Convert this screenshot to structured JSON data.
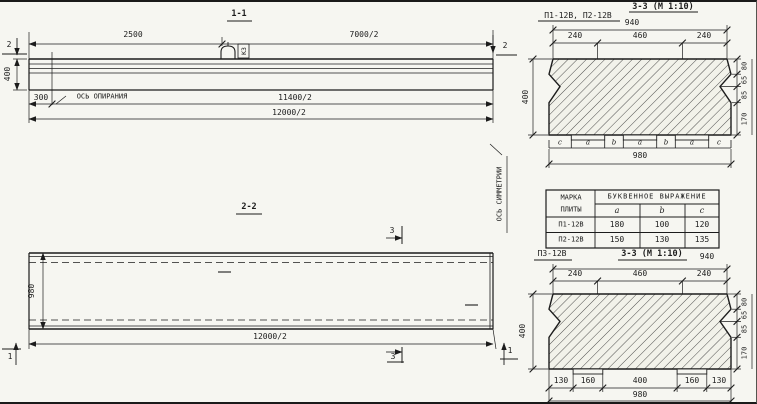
{
  "colors": {
    "paper": "#f6f6f1",
    "ink": "#1c1c1c"
  },
  "section_1_1": {
    "title": "1-1",
    "cut_marker_left": "2",
    "cut_marker_right": "2",
    "dim_top_left": "2500",
    "dim_top_right": "7000/2",
    "dim_height": "400",
    "dim_support_offset": "300",
    "dim_bottom_inner": "11400/2",
    "dim_bottom_outer": "12000/2",
    "support_axis_label": "ОСЬ ОПИРАНИЯ",
    "lifting_loop_label": "К3"
  },
  "section_2_2": {
    "title": "2-2",
    "dim_width": "980",
    "dim_length": "12000/2",
    "cut_marker_3_top": "3",
    "cut_marker_3_bottom": "3",
    "cut_marker_1_left": "1",
    "cut_marker_1_right": "1",
    "symmetry_axis_label": "ОСЬ СИММЕТРИИ"
  },
  "section_3_3_upper": {
    "plate_marks_label": "П1-12В, П2-12В",
    "title": "3-3 (М 1:10)",
    "dim_top_overall": "940",
    "dims_top": [
      "240",
      "460",
      "240"
    ],
    "dim_height": "400",
    "dims_right": [
      "80",
      "65",
      "85",
      "170"
    ],
    "letter_dims": [
      "c",
      "a",
      "b",
      "a",
      "b",
      "a",
      "c"
    ],
    "dim_bottom_overall": "980"
  },
  "table": {
    "header_col1_line1": "МАРКА",
    "header_col1_line2": "ПЛИТЫ",
    "header_expression": "БУКВЕННОЕ ВЫРАЖЕНИЕ",
    "subheaders": [
      "a",
      "b",
      "c"
    ],
    "rows": [
      {
        "mark": "П1-12В",
        "a": "180",
        "b": "100",
        "c": "120"
      },
      {
        "mark": "П2-12В",
        "a": "150",
        "b": "130",
        "c": "135"
      }
    ]
  },
  "section_3_3_lower": {
    "plate_mark_label": "П3-12В",
    "title": "3-3 (М 1:10)",
    "dim_top_overall": "940",
    "dims_top": [
      "240",
      "460",
      "240"
    ],
    "dim_height": "400",
    "dims_right": [
      "80",
      "65",
      "85",
      "170"
    ],
    "dims_bottom": [
      "130",
      "160",
      "400",
      "160",
      "130"
    ],
    "dim_bottom_overall": "980"
  }
}
